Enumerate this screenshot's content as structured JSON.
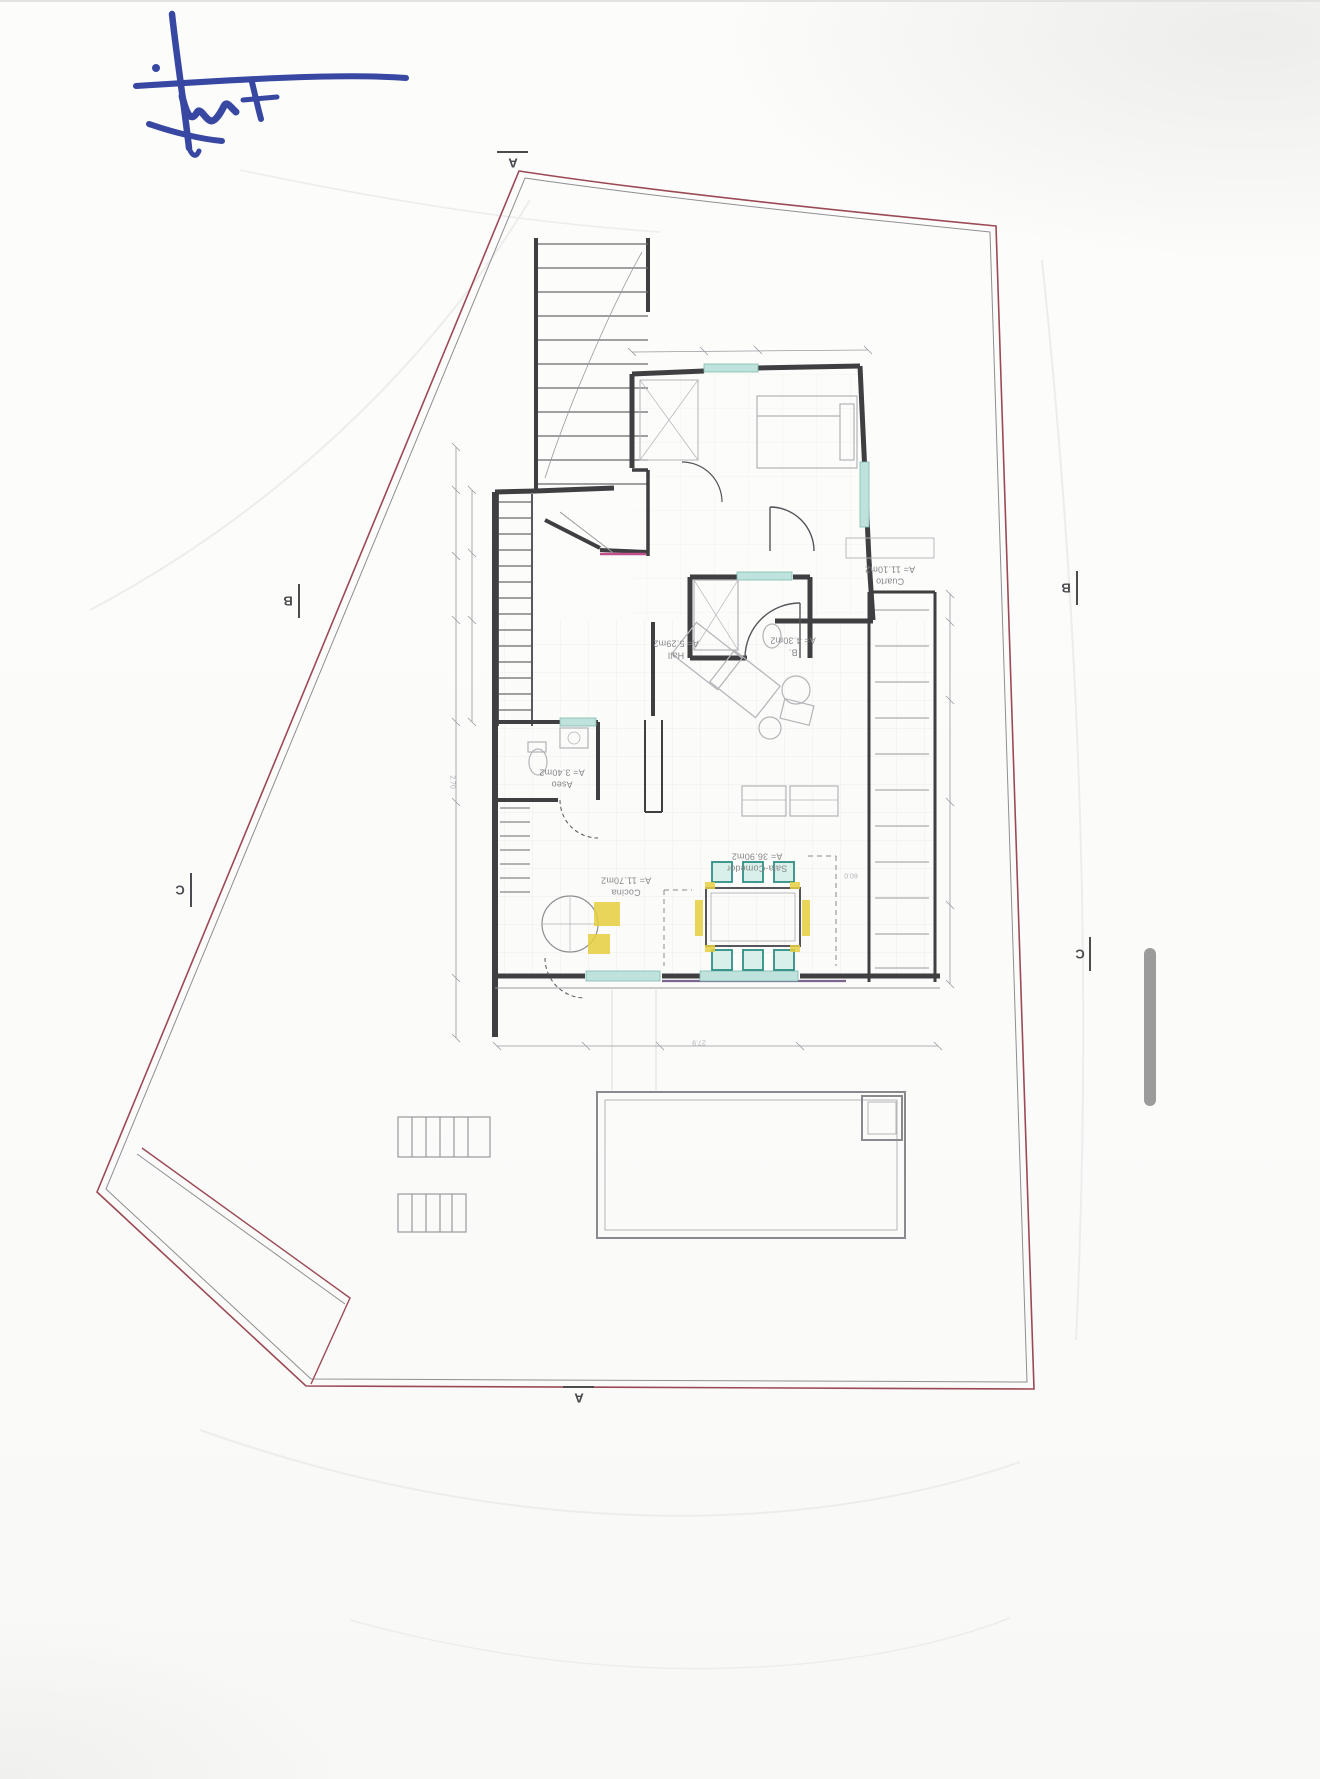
{
  "document_kind": "scanned architectural floor plan, drawing rotated 180 degrees",
  "signature": {
    "description": "handwritten blue ink signature",
    "ink_color": "#2e3f9e"
  },
  "plan": {
    "rooms": [
      {
        "name": "Cuarto",
        "area": "A= 11.10m2"
      },
      {
        "name": "Hall",
        "area": "A= 5.29m2"
      },
      {
        "name": "B.",
        "area": "A= 4.30m2"
      },
      {
        "name": "Aseo",
        "area": "A= 3.40m2"
      },
      {
        "name": "Cocina",
        "area": "A= 11.70m2"
      },
      {
        "name": "Sala-Comedor",
        "area": "A= 36.90m2"
      }
    ],
    "section_markers": {
      "a": "A",
      "b": "B",
      "c": "C"
    },
    "dimensions": {
      "d1": "2.70",
      "d2": "60.0",
      "d3": "27.9"
    }
  },
  "colors": {
    "site_boundary": "#9b4a55",
    "walls": "#3f3f42",
    "window_highlight": "#bfe3dc",
    "chair_highlight_teal": "#2e8f85",
    "kitchen_highlight_yellow": "#e6cf3f",
    "threshold_magenta": "#c0508a",
    "signature_ink": "#2e3f9e"
  },
  "viewer": {
    "scrollbar": "vertical scroll indicator"
  }
}
